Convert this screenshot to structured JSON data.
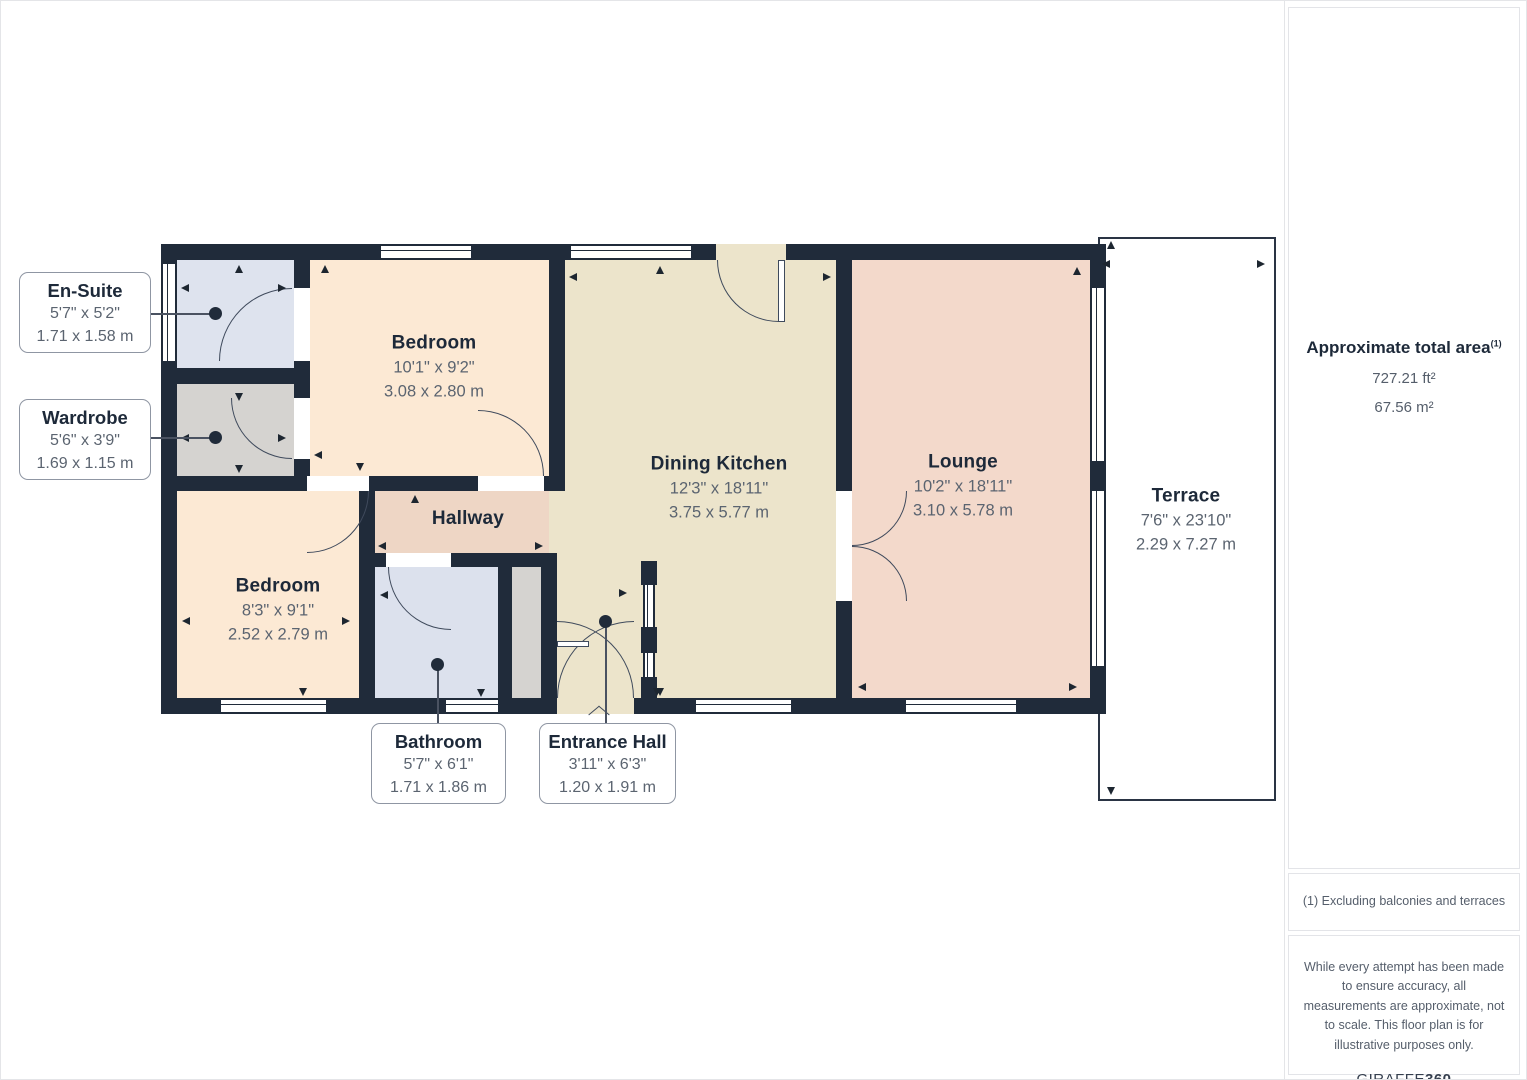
{
  "palette": {
    "wall": "#202b3a",
    "bedroom_fill": "#fce9d4",
    "kitchen_fill": "#ece4cb",
    "lounge_fill": "#f3d9cb",
    "hallway_fill": "#eed6c5",
    "bathroom_fill": "#dce1ed",
    "wardrobe_fill": "#d5d3d0",
    "terrace_fill": "#ffffff",
    "label_title": "#1d2939",
    "label_dims": "#5b6470"
  },
  "rooms": {
    "ensuite": {
      "name": "En-Suite",
      "imperial": "5'7\" x 5'2\"",
      "metric": "1.71 x 1.58 m"
    },
    "wardrobe": {
      "name": "Wardrobe",
      "imperial": "5'6\" x 3'9\"",
      "metric": "1.69 x 1.15 m"
    },
    "bedroom1": {
      "name": "Bedroom",
      "imperial": "10'1\" x 9'2\"",
      "metric": "3.08 x 2.80 m"
    },
    "bedroom2": {
      "name": "Bedroom",
      "imperial": "8'3\" x 9'1\"",
      "metric": "2.52 x 2.79 m"
    },
    "hallway": {
      "name": "Hallway"
    },
    "bathroom": {
      "name": "Bathroom",
      "imperial": "5'7\" x 6'1\"",
      "metric": "1.71 x 1.86 m"
    },
    "entrance": {
      "name": "Entrance Hall",
      "imperial": "3'11\" x 6'3\"",
      "metric": "1.20 x 1.91 m"
    },
    "dining": {
      "name": "Dining Kitchen",
      "imperial": "12'3\" x 18'11\"",
      "metric": "3.75 x 5.77 m"
    },
    "lounge": {
      "name": "Lounge",
      "imperial": "10'2\" x 18'11\"",
      "metric": "3.10 x 5.78 m"
    },
    "terrace": {
      "name": "Terrace",
      "imperial": "7'6\" x 23'10\"",
      "metric": "2.29 x 7.27 m"
    }
  },
  "sidebar": {
    "area_title": "Approximate total area",
    "area_footnote_mark": "(1)",
    "area_ft": "727.21 ft²",
    "area_m": "67.56 m²",
    "note": "(1) Excluding balconies and terraces",
    "disclaimer": "While every attempt has been made to ensure accuracy, all measurements are approximate, not to scale. This floor plan is for illustrative purposes only.",
    "brand_name": "GIRAFFE",
    "brand_suffix": "360"
  }
}
